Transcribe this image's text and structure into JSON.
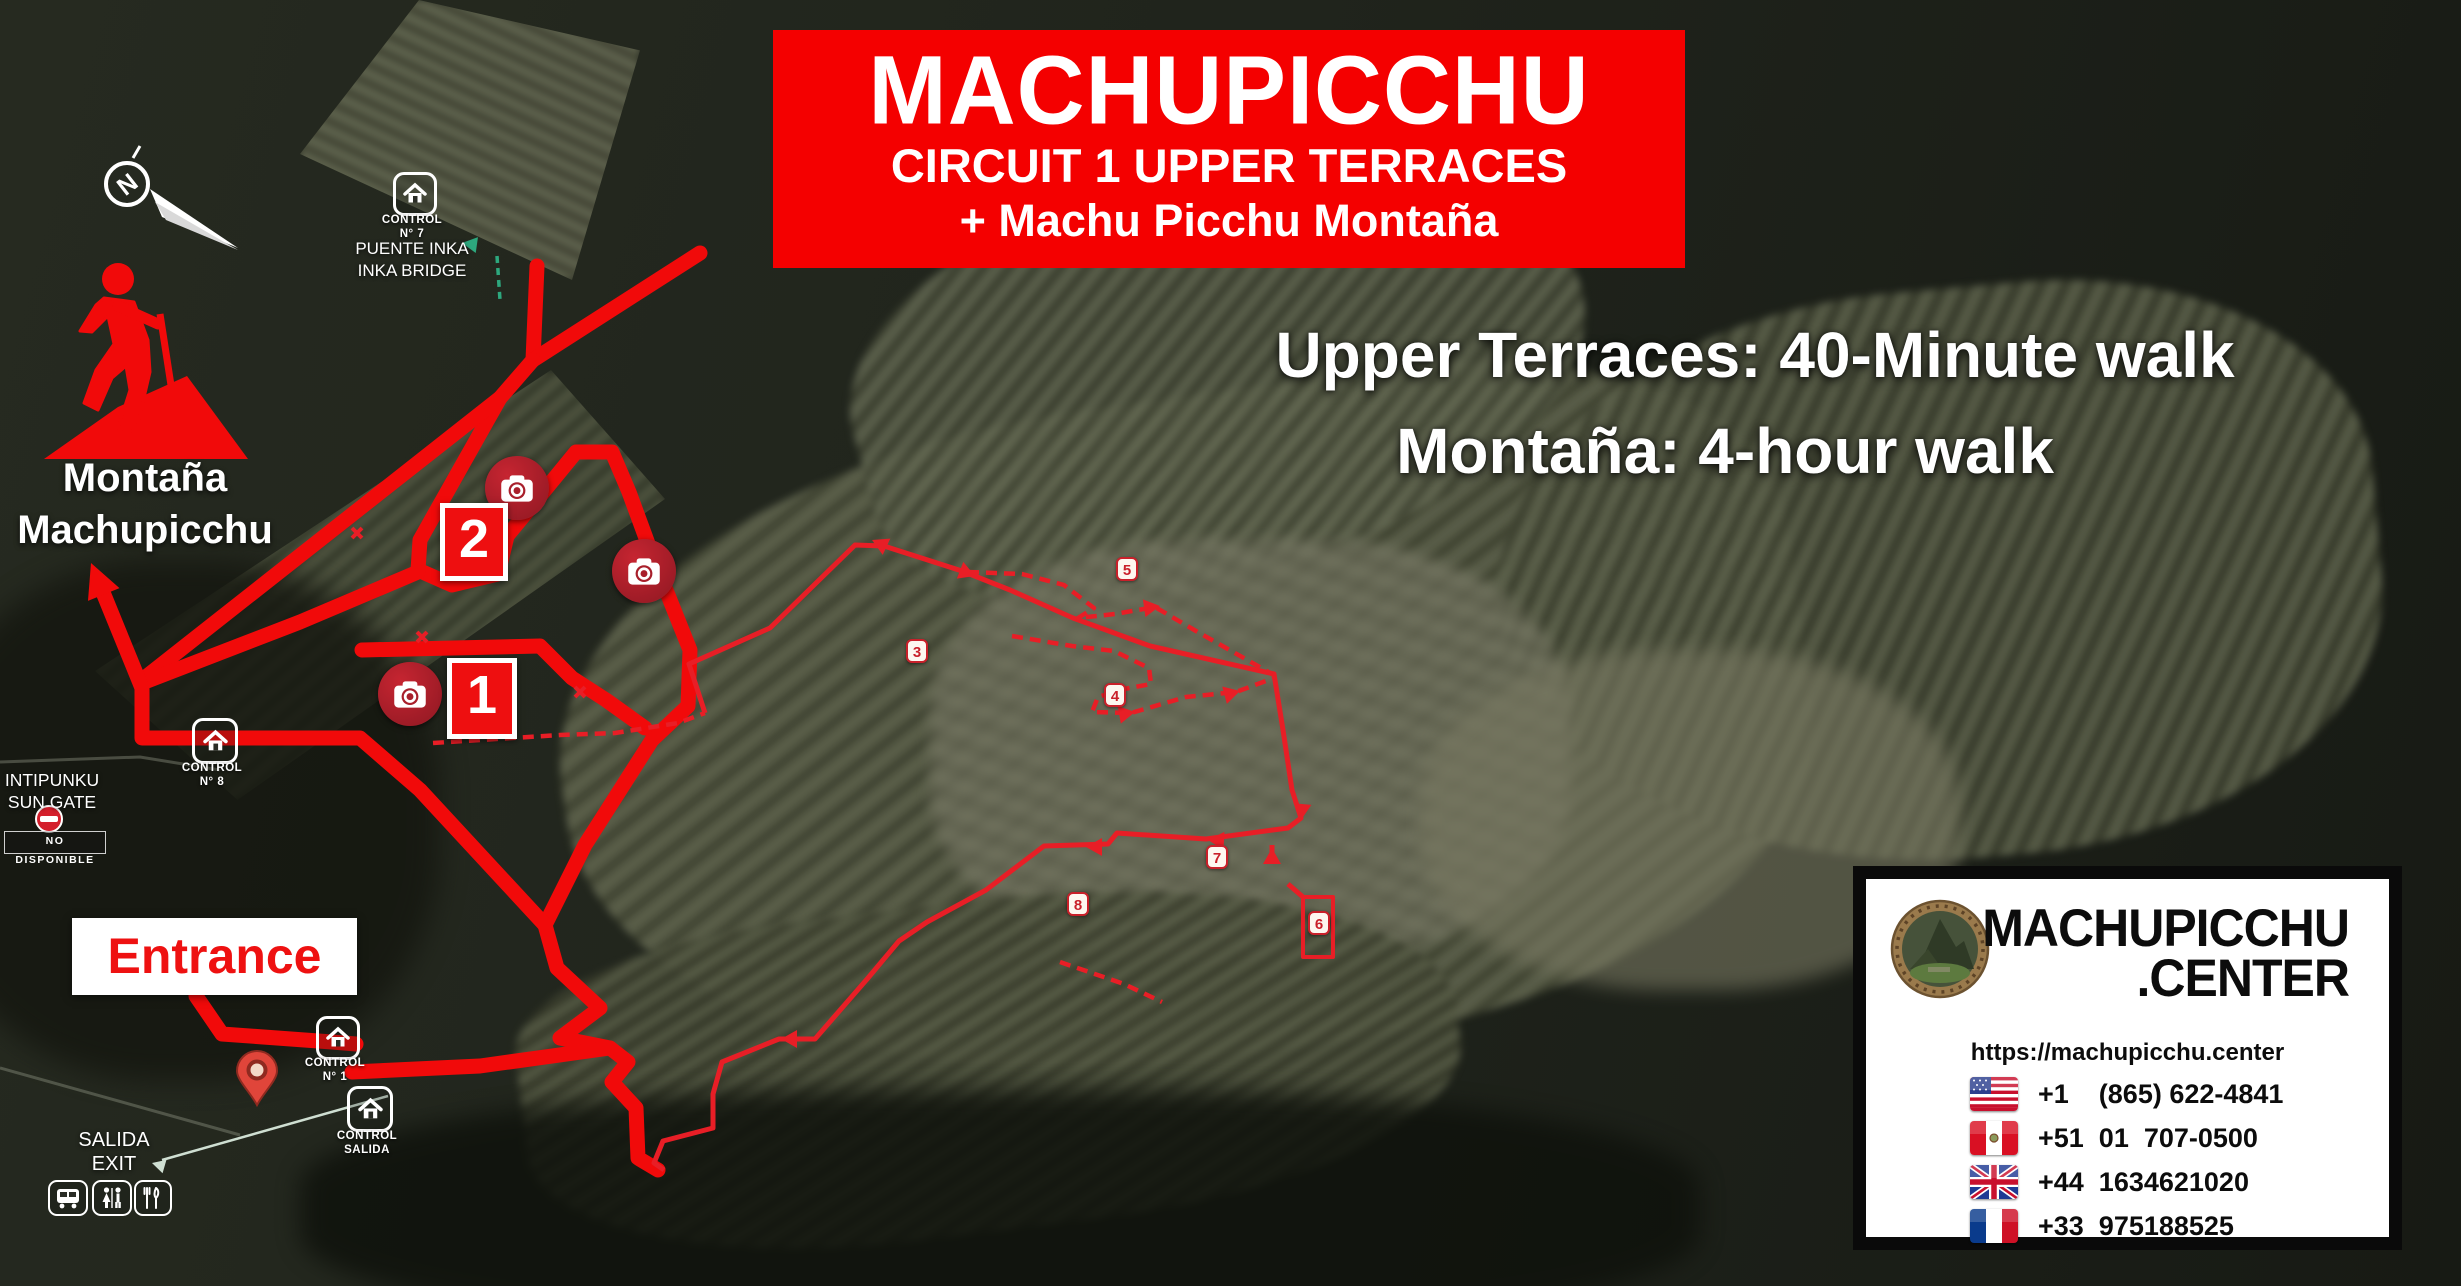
{
  "banner": {
    "title": "MACHUPICCHU",
    "line2": "CIRCUIT 1 UPPER TERRACES",
    "line3": "+ Machu Picchu Montaña"
  },
  "walk_info": {
    "line1": "Upper Terraces: 40-Minute walk",
    "line2": "Montaña: 4-hour walk"
  },
  "compass": {
    "letter": "N"
  },
  "montana_marker": {
    "line1": "Montaña",
    "line2": "Machupicchu"
  },
  "labels": {
    "puente_inka": {
      "control": "CONTROL",
      "number": "N° 7",
      "line1": "PUENTE INKA",
      "line2": "INKA BRIDGE"
    },
    "intipunku": {
      "line1": "INTIPUNKU",
      "line2": "SUN GATE",
      "unavailable": "NO DISPONIBLE"
    },
    "control_8": {
      "control": "CONTROL",
      "number": "N° 8"
    },
    "control_1": {
      "control": "CONTROL",
      "number": "N° 1"
    },
    "control_salida": {
      "control": "CONTROL",
      "number": "SALIDA"
    },
    "entrance": "Entrance",
    "exit": {
      "line1": "SALIDA",
      "line2": "EXIT"
    }
  },
  "waypoints": {
    "big": [
      {
        "n": "1"
      },
      {
        "n": "2"
      }
    ],
    "small": [
      {
        "n": "3"
      },
      {
        "n": "4"
      },
      {
        "n": "5"
      },
      {
        "n": "6"
      },
      {
        "n": "7"
      },
      {
        "n": "8"
      }
    ]
  },
  "contact": {
    "brand_line1": "MACHUPICCHU",
    "brand_line2": ".CENTER",
    "url": "https://machupicchu.center",
    "phones": [
      {
        "country": "usa",
        "number": "+1    (865) 622-4841"
      },
      {
        "country": "peru",
        "number": "+51  01  707-0500"
      },
      {
        "country": "uk",
        "number": "+44  1634621020"
      },
      {
        "country": "france",
        "number": "+33  975188525"
      }
    ]
  },
  "icons": {
    "compass": "north-compass-icon",
    "hiker": "hiker-on-mountain-icon",
    "camera": "photo-spot-camera-icon",
    "control": "control-house-icon",
    "pin": "entrance-location-pin",
    "no_entry": "no-entry-icon",
    "bus": "bus-icon",
    "restroom": "restroom-icon",
    "restaurant": "restaurant-icon"
  },
  "colors": {
    "banner_red": "#f40000",
    "route_red": "#f10a0a",
    "circuit_red": "#e81e26",
    "camera_red": "#a81f2b",
    "green_arrow": "#2da87e"
  }
}
